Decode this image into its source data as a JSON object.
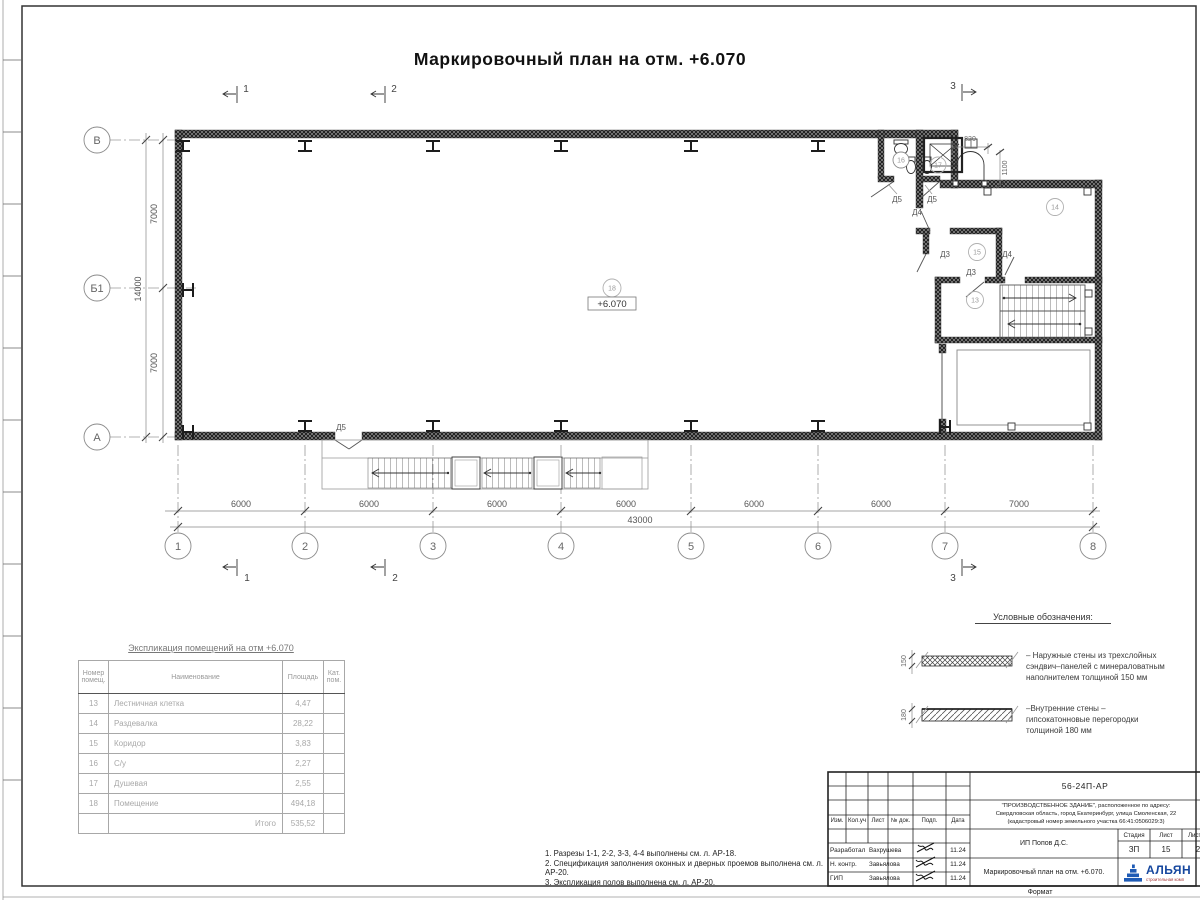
{
  "sheet": {
    "title": "Маркировочный план на отм. +6.070",
    "format_label": "Формат"
  },
  "plan": {
    "elevation": "+6.070",
    "rooms": {
      "hall": "18",
      "locker": "14",
      "corridor": "15",
      "stairwell": "13",
      "wc": "16",
      "shower": "17"
    },
    "doors": {
      "wc": "Д5",
      "shower": "Д5",
      "hall_top": "Д4",
      "corridor_left": "Д3",
      "corridor_stair": "Д3",
      "locker_stair": "Д4",
      "exit": "Д5"
    }
  },
  "axes": {
    "cols": [
      "1",
      "2",
      "3",
      "4",
      "5",
      "6",
      "7",
      "8"
    ],
    "rows": [
      "В",
      "Б1",
      "А"
    ],
    "sections": [
      "1",
      "2",
      "3"
    ]
  },
  "dims": {
    "bottom": [
      "6000",
      "6000",
      "6000",
      "6000",
      "6000",
      "6000",
      "7000"
    ],
    "bottom_total": "43000",
    "left": [
      "7000",
      "7000"
    ],
    "left_total": "14000",
    "door_width": "820",
    "door_depth": "1100",
    "legend_ext": "150",
    "legend_int": "180"
  },
  "legend": {
    "title": "Условные обозначения:",
    "external": "– Наружные стены из трехслойных\nсэндвич–панелей с минераловатным\nнаполнителем толщиной 150 мм",
    "internal": "–Внутренние стены –\nгипсокатонновые перегородки\nтолщиной 180 мм"
  },
  "room_table": {
    "title": "Экспликация помещений на отм +6.070",
    "headers": [
      "Номер\nпомещ.",
      "Наименование",
      "Площадь",
      "Кат.\nпом."
    ],
    "rows": [
      [
        "13",
        "Лестничная клетка",
        "4,47",
        ""
      ],
      [
        "14",
        "Раздевалка",
        "28,22",
        ""
      ],
      [
        "15",
        "Коридор",
        "3,83",
        ""
      ],
      [
        "16",
        "С/у",
        "2,27",
        ""
      ],
      [
        "17",
        "Душевая",
        "2,55",
        ""
      ],
      [
        "18",
        "Помещение",
        "494,18",
        ""
      ]
    ],
    "total_label": "Итого",
    "total_value": "535,52"
  },
  "notes": [
    "1. Разрезы 1-1, 2-2, 3-3, 4-4 выполнены см. л. АР-18.",
    "2. Спецификация заполнения оконных и дверных проемов выполнена см. л. АР-20.",
    "3. Экспликация полов выполнена см. л. АР-20."
  ],
  "title_block": {
    "doc_number": "56-24П-АР",
    "project_lines": "\"ПРОИЗВОДСТВЕННОЕ ЗДАНИЕ\", расположенное по адресу:\nСвердловская область, город Екатеринбург, улица Смоленская, 22\n(кадастровый номер земельного участка 66:41:0506029:3)",
    "client": "ИП Попов Д.С.",
    "sheet_name": "Маркировочный план на отм. +6.070.",
    "cols": [
      "Изм.",
      "Кол.уч",
      "Лист",
      "№ док.",
      "Подп.",
      "Дата"
    ],
    "rows": [
      {
        "role": "Разработал",
        "name": "Вахрушева",
        "date": "11.24"
      },
      {
        "role": "Н. контр.",
        "name": "Завьялова",
        "date": "11.24"
      },
      {
        "role": "ГИП",
        "name": "Завьялова",
        "date": "11.24"
      }
    ],
    "stage_label": "Стадия",
    "sheet_label": "Лист",
    "sheets_label": "Листов",
    "stage": "ЗП",
    "sheet": "15",
    "sheets": "2",
    "logo": "АЛЬЯН",
    "logo_sub": "строительная комп",
    "accent_blue": "#16479e"
  }
}
